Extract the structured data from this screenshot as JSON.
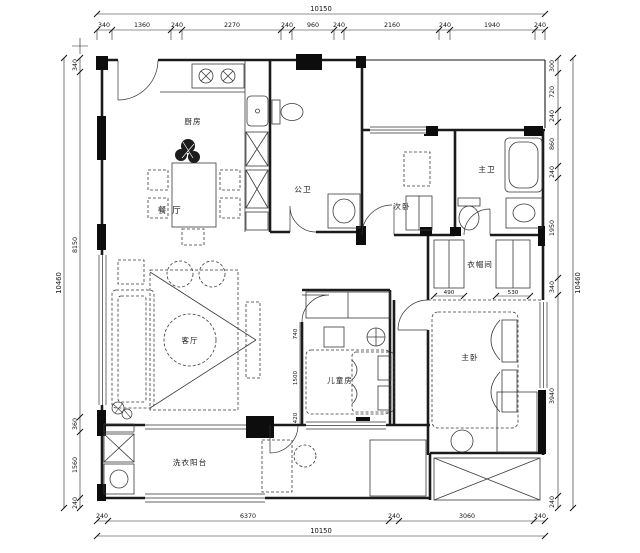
{
  "drawing": {
    "type": "apartment-floor-plan",
    "colors": {
      "ink": "#1b1b1b",
      "paper": "#ffffff"
    },
    "rooms": {
      "kitchen": "厨房",
      "dining": "餐 厅",
      "guest_bath": "公卫",
      "second_bedroom": "次卧",
      "master_bath": "主卫",
      "closet": "衣帽间",
      "living": "客厅",
      "kids_room": "儿童房",
      "master_bedroom": "主卧",
      "laundry_balcony": "洗衣阳台"
    },
    "dims": {
      "top": {
        "total": "10150",
        "segments": [
          "340",
          "1360",
          "240",
          "2270",
          "240",
          "960",
          "240",
          "2160",
          "240",
          "1940",
          "240"
        ]
      },
      "bottom": {
        "total": "10150",
        "segments": [
          "240",
          "6370",
          "240",
          "3060",
          "240"
        ]
      },
      "left": {
        "total": "10460",
        "segments": [
          "340",
          "8150",
          "360",
          "1560",
          "240"
        ]
      },
      "right": {
        "total": "10460",
        "segments": [
          "300",
          "720",
          "240",
          "860",
          "240",
          "1950",
          "340",
          "3940",
          "240"
        ]
      },
      "closet_left": "490",
      "closet_right": "530",
      "kids_left": [
        "740",
        "1500",
        "420"
      ]
    }
  }
}
